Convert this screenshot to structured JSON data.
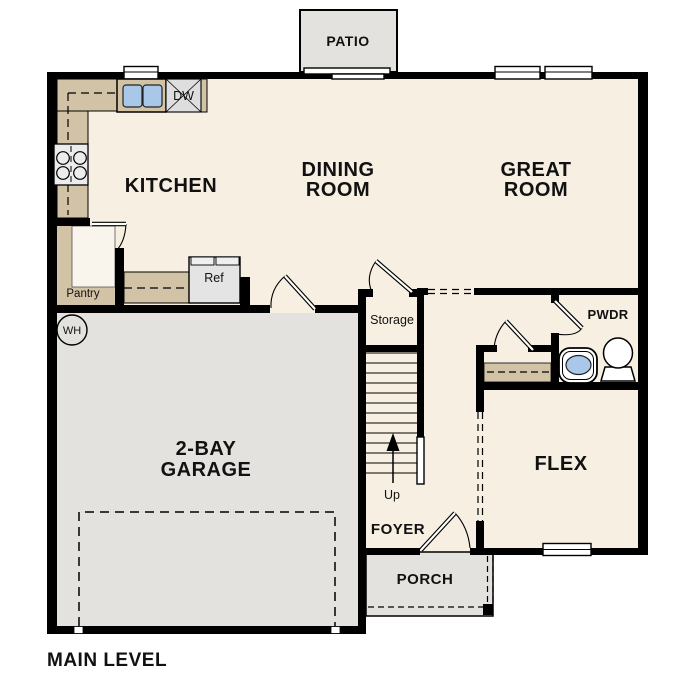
{
  "plan": {
    "level_label": "MAIN LEVEL",
    "labels": {
      "patio": "PATIO",
      "kitchen": "KITCHEN",
      "dining_line1": "DINING",
      "dining_line2": "ROOM",
      "great_line1": "GREAT",
      "great_line2": "ROOM",
      "garage_line1": "2-BAY",
      "garage_line2": "GARAGE",
      "flex": "FLEX",
      "foyer": "FOYER",
      "porch": "PORCH",
      "pwdr": "PWDR",
      "storage": "Storage",
      "pantry": "Pantry",
      "up": "Up",
      "ref": "Ref",
      "dw": "DW",
      "wh": "WH"
    },
    "colors": {
      "background": "#ffffff",
      "floor": "#f6efe2",
      "counter": "#d2c3a6",
      "hardscape": "#e4e2df",
      "wall": "#000000",
      "sink_blue": "#a9c8e9",
      "appliance_gray": "#e6e6e6",
      "fixture_white": "#ffffff"
    }
  }
}
